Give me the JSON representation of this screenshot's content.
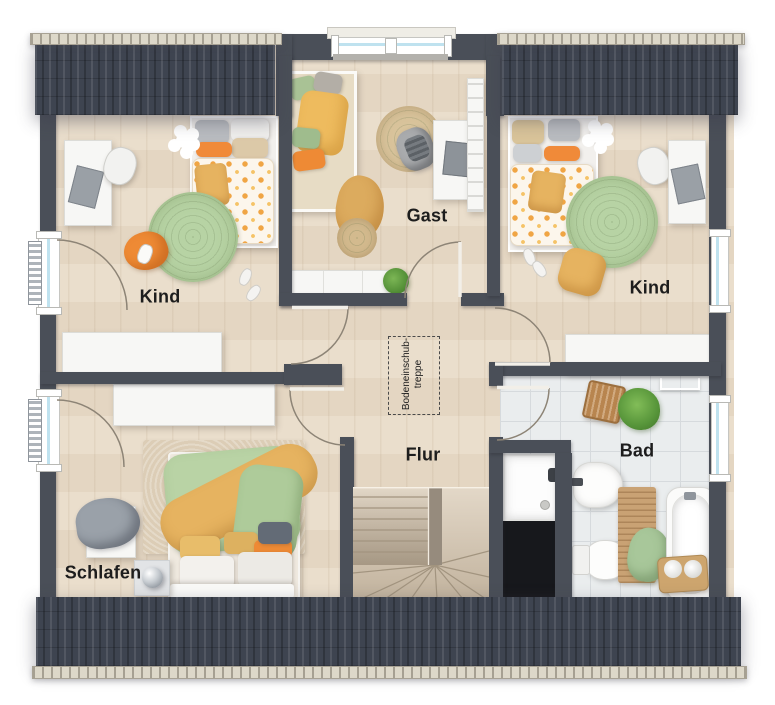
{
  "plan": {
    "rooms": [
      {
        "id": "kind-left",
        "label": "Kind"
      },
      {
        "id": "gast",
        "label": "Gast"
      },
      {
        "id": "kind-right",
        "label": "Kind"
      },
      {
        "id": "flur",
        "label": "Flur"
      },
      {
        "id": "schlafen",
        "label": "Schlafen"
      },
      {
        "id": "bad",
        "label": "Bad"
      }
    ],
    "attic_hatch": {
      "line1": "Bodeneinschub-",
      "line2": "treppe"
    },
    "colors": {
      "wall": "#4a4f58",
      "roof": "#3e4450",
      "gutter": "#ddd8c9",
      "floor_wood": "#e9dcc9",
      "floor_tile": "#eaedee",
      "tile_line": "#d6dadd",
      "rug_green": "#b7d3a4",
      "jute": "#d9c49c",
      "accent_orange": "#ee8a35",
      "accent_yellow": "#e6b360",
      "duvet_green": "#b9d3a5",
      "furniture_white": "#f7f7f5",
      "glass": "#bfe2ef",
      "stair_wood": "#d6c9b6",
      "void": "#17181c",
      "label_ink": "#1d1d1d"
    }
  }
}
